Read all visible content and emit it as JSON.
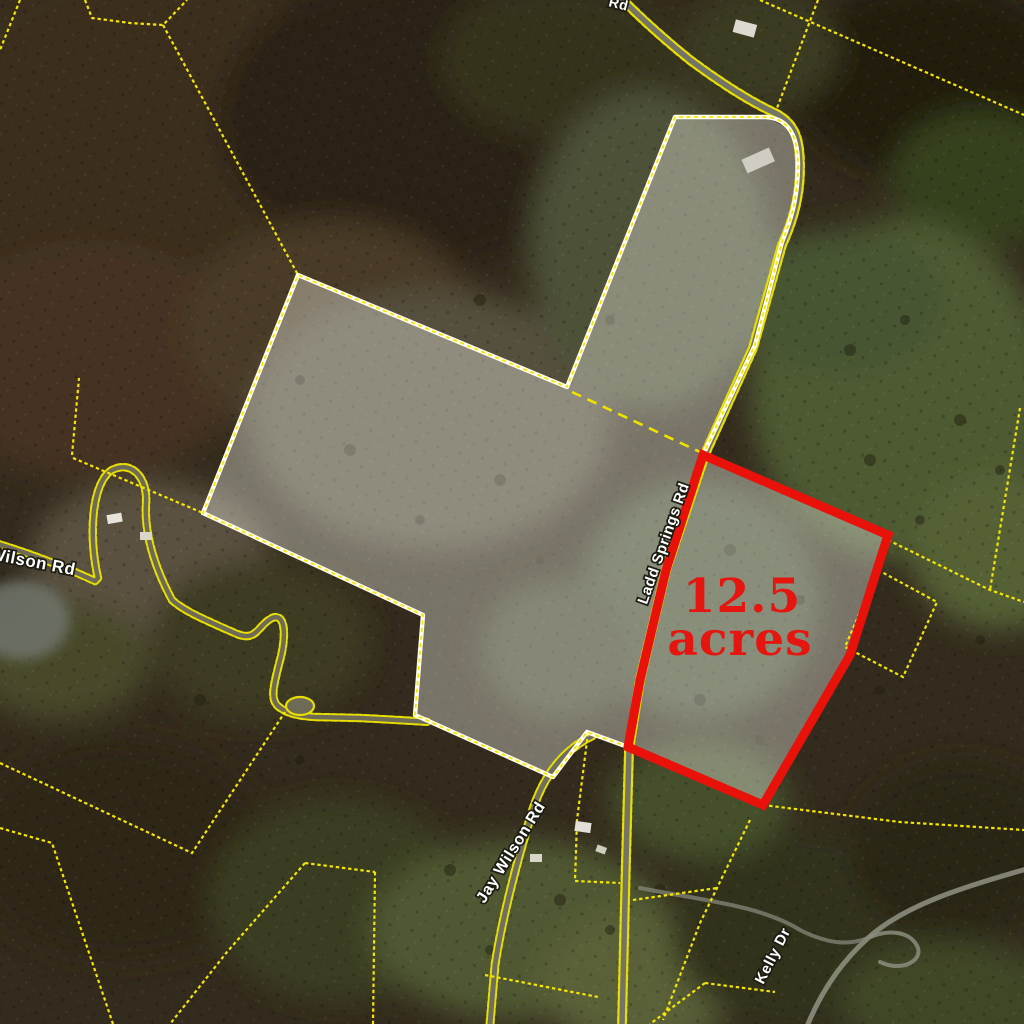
{
  "map": {
    "acreage": {
      "value": "12.5",
      "unit": "acres"
    },
    "roads": [
      {
        "id": "jay-wilson-left",
        "label": "Jay Wilson Rd"
      },
      {
        "id": "jay-wilson-bottom",
        "label": "Jay Wilson Rd"
      },
      {
        "id": "ladd-springs",
        "label": "Ladd Springs Rd"
      },
      {
        "id": "kelly-dr",
        "label": "Kelly Dr"
      },
      {
        "id": "top-edge-partial",
        "label": "Rd"
      }
    ],
    "colors": {
      "highlight_outline": "#e8120b",
      "acreage_text": "#e51510",
      "parcel_casing": "#fffdf0",
      "parcel_line_yellow": "#f5e602",
      "label_fill": "#ffffff",
      "label_halo": "#1c1c12"
    }
  }
}
